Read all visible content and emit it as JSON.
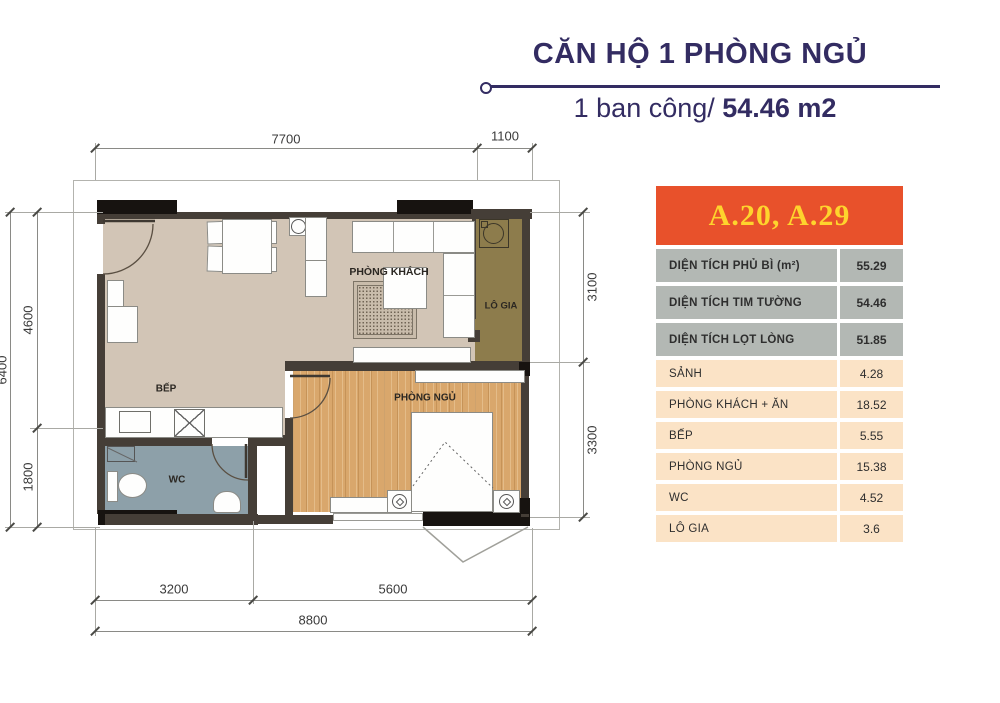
{
  "header": {
    "title": "CĂN HỘ 1 PHÒNG NGỦ",
    "subtitle_regular": "1 ban công/ ",
    "subtitle_bold": "54.46 m2"
  },
  "card": {
    "unit_label": "A.20, A.29",
    "rows": [
      {
        "label": "DIỆN TÍCH PHỦ BÌ (m²)",
        "value": "55.29"
      },
      {
        "label": "DIỆN TÍCH TIM TƯỜNG",
        "value": "54.46"
      },
      {
        "label": "DIỆN TÍCH LỌT LÒNG",
        "value": "51.85"
      },
      {
        "label": "SẢNH",
        "value": "4.28"
      },
      {
        "label": "PHÒNG KHÁCH + ĂN",
        "value": "18.52"
      },
      {
        "label": "BẾP",
        "value": "5.55"
      },
      {
        "label": "PHÒNG NGỦ",
        "value": "15.38"
      },
      {
        "label": "WC",
        "value": "4.52"
      },
      {
        "label": "LÔ GIA",
        "value": "3.6"
      }
    ]
  },
  "plan": {
    "rooms": {
      "living": "PHÒNG KHÁCH",
      "kitchen": "BẾP",
      "bedroom": "PHÒNG NGỦ",
      "wc": "WC",
      "balcony": "LÔ GIA"
    },
    "dims": {
      "top1": "7700",
      "top2": "1100",
      "left_outer": "6400",
      "left1": "4600",
      "left2": "1800",
      "right1": "3100",
      "right2": "3300",
      "bottom1": "3200",
      "bottom2": "5600",
      "bottom3": "8800"
    }
  },
  "colors": {
    "accent_navy": "#332c62",
    "header_orange": "#e8512b",
    "header_yellow": "#fed42d",
    "row_gray": "#b3b8b4",
    "row_peach": "#fbe3c6",
    "floor_beige": "#d2c5b6",
    "floor_wood": "#d9a76c",
    "balcony_olive": "#8d7c4c",
    "wc_blue": "#8da0a9"
  }
}
